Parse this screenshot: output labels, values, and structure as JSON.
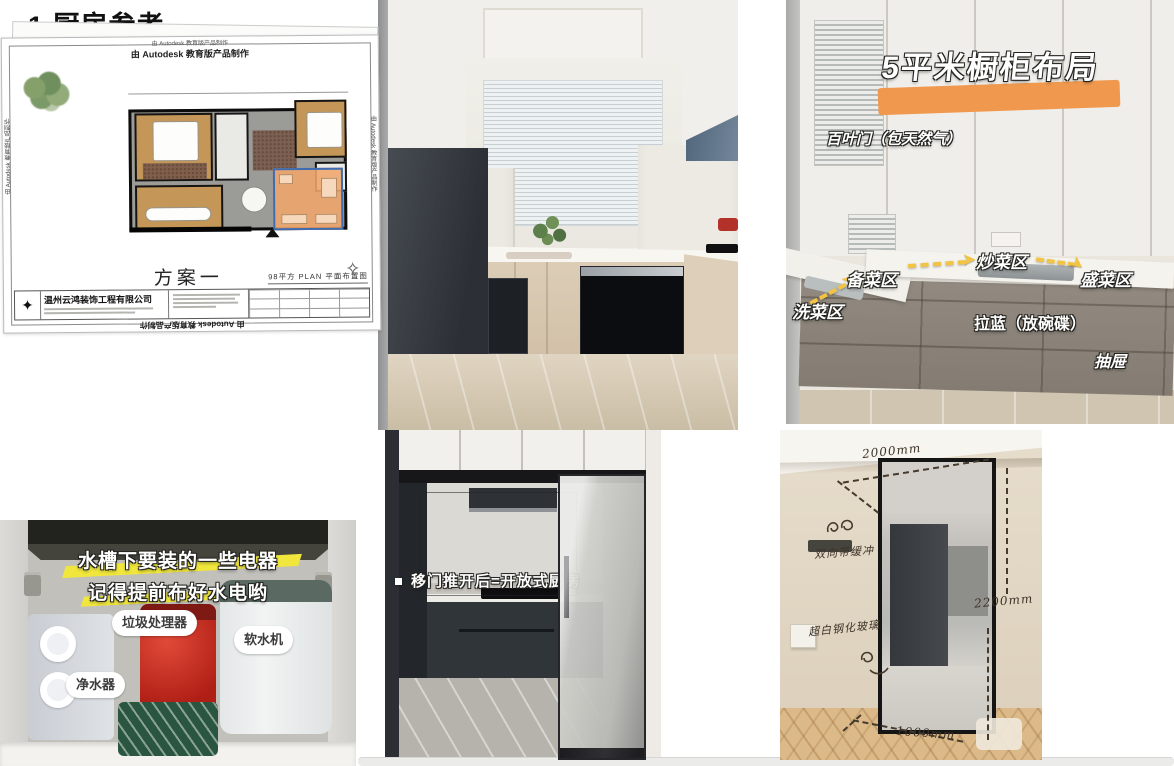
{
  "page": {
    "heading": "1.厨房参考"
  },
  "floor_plan": {
    "watermark": "由 Autodesk 教育版产品制作",
    "plan_name": "方案一",
    "sheet_info": "98平方  PLAN  平面布置图",
    "company": "温州云鸿装饰工程有限公司",
    "compass_glyph": "✧"
  },
  "layout_photo": {
    "title": "5平米橱柜布局",
    "label_louver": "百叶门（包天然气）",
    "label_prep": "备菜区",
    "label_stirfry": "炒菜区",
    "label_plate": "盛菜区",
    "label_wash": "洗菜区",
    "label_pullout": "拉蓝（放碗碟）",
    "label_drawer": "抽屉",
    "arrow_glyph": "➤"
  },
  "undersink_photo": {
    "caption_line1": "水槽下要装的一些电器",
    "caption_line2": "记得提前布好水电哟",
    "label_disposal": "垃圾处理器",
    "label_purifier": "净水器",
    "label_softener": "软水机"
  },
  "sliding_door_photo": {
    "caption": "移门推开后=开放式厨房"
  },
  "door_spec_photo": {
    "dim_top": "2000mm",
    "dim_side": "2200mm",
    "dim_bottom": "1000mm",
    "note_buffer": "双向带缓冲",
    "note_glass": "超白钢化玻璃"
  },
  "colors": {
    "highlight_orange": "#f0994e",
    "arrow_yellow": "#f2c445",
    "zigzag_yellow": "#f0e63c",
    "disposal_red": "#b01f16",
    "kitchen_overlay": "#f0a66b"
  }
}
